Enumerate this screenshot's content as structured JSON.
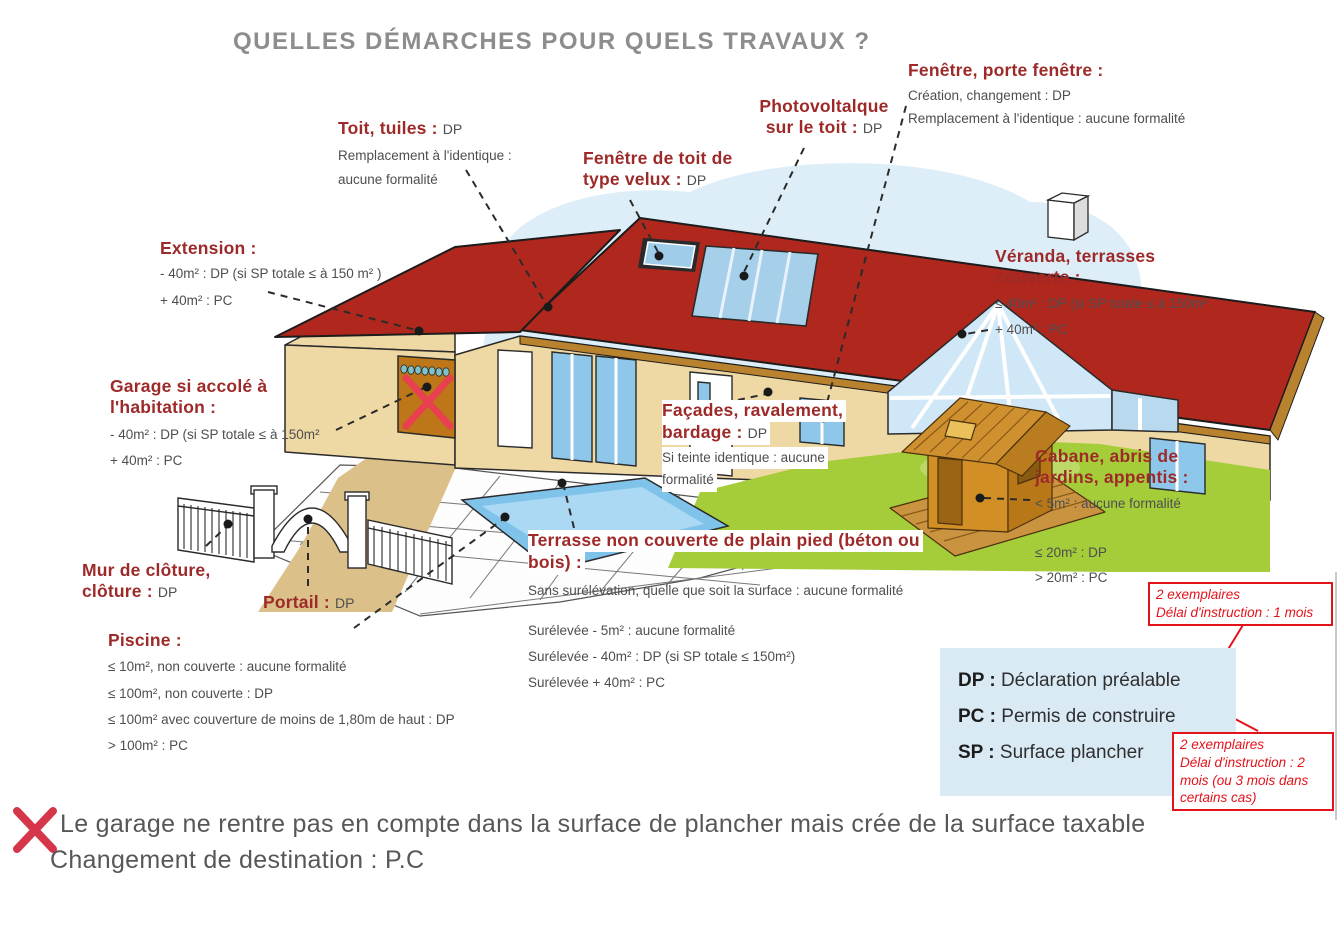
{
  "title": "QUELLES DÉMARCHES POUR QUELS TRAVAUX ?",
  "labels": {
    "toit": {
      "heading": "Toit, tuiles :",
      "value": "DP",
      "body": [
        "Remplacement à l'identique :",
        "aucune formalité"
      ]
    },
    "velux": {
      "heading_line1": "Fenêtre de toit de",
      "heading_line2": "type velux :",
      "value": "DP"
    },
    "photovoltaique": {
      "heading_line1": "Photovoltalque",
      "heading_line2": "sur le toit :",
      "value": "DP"
    },
    "fenetre_porte": {
      "heading": "Fenêtre, porte fenêtre :",
      "body": [
        "Création, changement : DP",
        "Remplacement à l'identique : aucune formalité"
      ]
    },
    "extension": {
      "heading": "Extension :",
      "body": [
        "- 40m² : DP (si SP totale ≤ à 150 m² )",
        "+ 40m² : PC"
      ]
    },
    "veranda": {
      "heading_line1": "Véranda, terrasses",
      "heading_line2": "couverte :",
      "body": [
        "≤ 40m² : DP (si SP totale ≤ à 150m²",
        "+ 40m² : PC"
      ]
    },
    "garage": {
      "heading_line1": "Garage si accolé à",
      "heading_line2": "l'habitation :",
      "body": [
        "- 40m² : DP (si SP totale ≤ à 150m²",
        "+ 40m² : PC"
      ]
    },
    "facades": {
      "heading_line1": "Façades, ravalement,",
      "heading_line2": "bardage :",
      "value": "DP",
      "body": [
        "Si teinte identique : aucune",
        "formalité"
      ]
    },
    "cabane": {
      "heading_line1": "Cabane, abris de",
      "heading_line2": "jardins, appentis :",
      "body_top": "< 5m² : aucune formalité",
      "body_bottom": [
        "≤ 20m² : DP",
        "> 20m² : PC"
      ]
    },
    "mur": {
      "heading_line1": "Mur de clôture,",
      "heading_line2": "clôture :",
      "value": "DP"
    },
    "portail": {
      "heading": "Portail :",
      "value": "DP"
    },
    "piscine": {
      "heading": "Piscine :",
      "body": [
        "≤ 10m², non couverte : aucune formalité",
        "≤ 100m², non couverte : DP",
        "≤ 100m² avec couverture de moins de 1,80m de haut : DP",
        "> 100m² : PC"
      ]
    },
    "terrasse": {
      "heading_line1": "Terrasse non couverte de plain pied (béton ou",
      "heading_line2": "bois) :",
      "body_top": "Sans surélévation, quelle que soit la surface : aucune formalité",
      "body_bottom": [
        "Surélevée - 5m² : aucune formalité",
        "Surélevée - 40m² : DP (si SP totale ≤ 150m²)",
        "Surélevée + 40m² : PC"
      ]
    }
  },
  "legend": {
    "items": [
      {
        "abbr": "DP :",
        "text": "Déclaration préalable"
      },
      {
        "abbr": "PC :",
        "text": "Permis de construire"
      },
      {
        "abbr": "SP :",
        "text": "Surface plancher"
      }
    ]
  },
  "annotations": {
    "dp_box": {
      "line1": "2 exemplaires",
      "line2": "Délai d'instruction : 1 mois"
    },
    "pc_box": {
      "line1": "2 exemplaires",
      "line2": "Délai d'instruction : 2 mois (ou 3 mois dans certains cas)"
    }
  },
  "footer": {
    "line1": "Le garage ne rentre pas en compte dans la surface de plancher mais crée de la surface taxable",
    "line2": "Changement de destination : P.C"
  },
  "colors": {
    "heading_red": "#9d2a28",
    "body_gray": "#4e4e50",
    "title_gray": "#8d8d8d",
    "annotation_red": "#e3131b",
    "legend_bg": "#d9eaf5",
    "roof_red": "#b0281d",
    "wall_tan": "#eed9a4",
    "glass_blue": "#8ec7ea",
    "lawn_green": "#a5cd3a",
    "cross_red": "#d5364a"
  },
  "icons": [
    "red-x-icon",
    "arrow-icon"
  ]
}
